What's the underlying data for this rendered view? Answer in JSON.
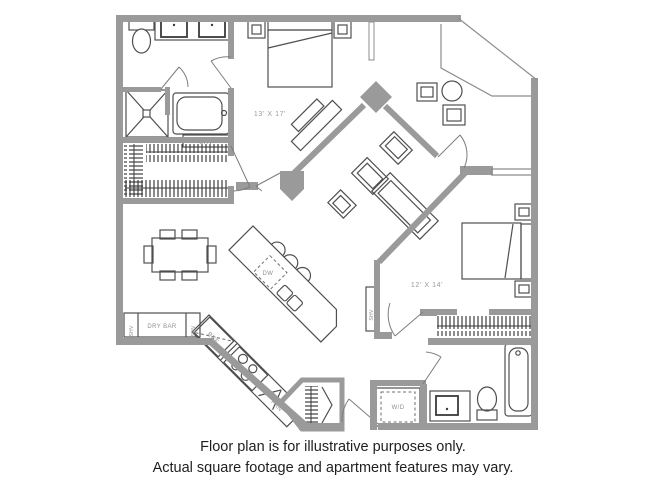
{
  "floor_plan": {
    "labels": {
      "bedroom1_dim": "13' X 17'",
      "bedroom2_dim": "12' X 14'",
      "bath_shelf": "SHV",
      "hall_shelf": "SHV",
      "dry_bar": "DRY BAR",
      "dry_bar_shelf_left": "SHV",
      "dry_bar_shelf_right": "SHV",
      "dishwasher": "DW",
      "refrigerator": "REF",
      "pantry": "PAN",
      "washer_dryer": "W/D"
    },
    "disclaimer": {
      "line1": "Floor plan is for illustrative purposes only.",
      "line2": "Actual square footage and apartment features may vary."
    },
    "colors": {
      "wall": "#9a9a9a",
      "fixture_line": "#4f4f4f",
      "label_text": "#8f8f8f",
      "disclaimer_text": "#1f1f1f",
      "background": "#ffffff"
    }
  }
}
